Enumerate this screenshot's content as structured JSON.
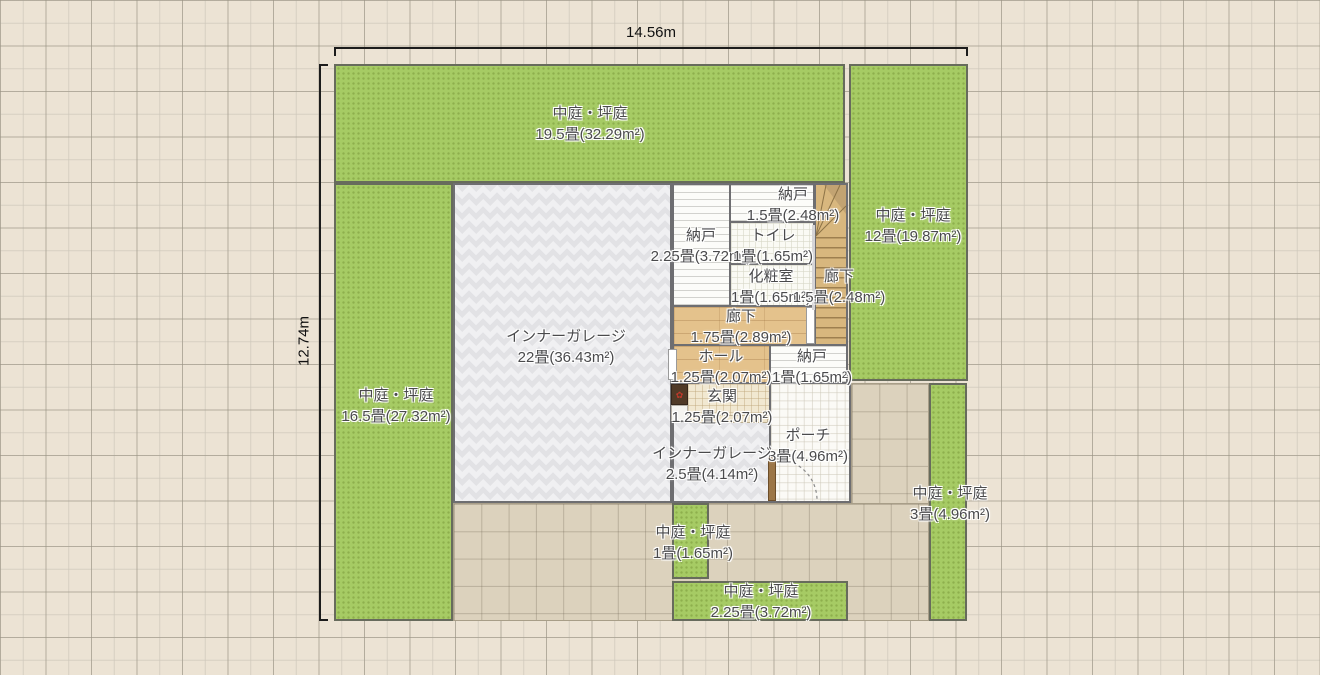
{
  "plan": {
    "dimensions": {
      "width_label": "14.56m",
      "height_label": "12.74m"
    },
    "areas": {
      "courtyard_top": {
        "name": "中庭・坪庭",
        "size": "19.5畳(32.29m²)"
      },
      "courtyard_right": {
        "name": "中庭・坪庭",
        "size": "12畳(19.87m²)"
      },
      "courtyard_left": {
        "name": "中庭・坪庭",
        "size": "16.5畳(27.32m²)"
      },
      "courtyard_bottom_small": {
        "name": "中庭・坪庭",
        "size": "1畳(1.65m²)"
      },
      "courtyard_bottom": {
        "name": "中庭・坪庭",
        "size": "2.25畳(3.72m²)"
      },
      "courtyard_bottom_right": {
        "name": "中庭・坪庭",
        "size": "3畳(4.96m²)"
      },
      "inner_garage": {
        "name": "インナーガレージ",
        "size": "22畳(36.43m²)"
      },
      "inner_garage_small": {
        "name": "インナーガレージ",
        "size": "2.5畳(4.14m²)"
      },
      "storage_top": {
        "name": "納戸",
        "size": "1.5畳(2.48m²)"
      },
      "storage_left": {
        "name": "納戸",
        "size": "2.25畳(3.72m²)"
      },
      "storage_hall": {
        "name": "納戸",
        "size": "1畳(1.65m²)"
      },
      "toilet": {
        "name": "トイレ",
        "size": "1畳(1.65m²)"
      },
      "powder_room": {
        "name": "化粧室",
        "size": "1畳(1.65m²)"
      },
      "corridor_stairs": {
        "name": "廊下",
        "size": "1.5畳(2.48m²)"
      },
      "corridor": {
        "name": "廊下",
        "size": "1.75畳(2.89m²)"
      },
      "hall": {
        "name": "ホール",
        "size": "1.25畳(2.07m²)"
      },
      "entrance": {
        "name": "玄関",
        "size": "1.25畳(2.07m²)"
      },
      "porch": {
        "name": "ポーチ",
        "size": "3畳(4.96m²)"
      }
    },
    "colors": {
      "courtyard_green": "#a6cb64",
      "canvas_background": "#ece3d4",
      "terrace_tile": "#dcd2bd",
      "wood_floor": "#e4c28c",
      "dimension_line": "#1c1c1c",
      "label_text": "#4a4a4c"
    },
    "icons": {
      "shoe_cabinet_accent": "✿"
    }
  }
}
